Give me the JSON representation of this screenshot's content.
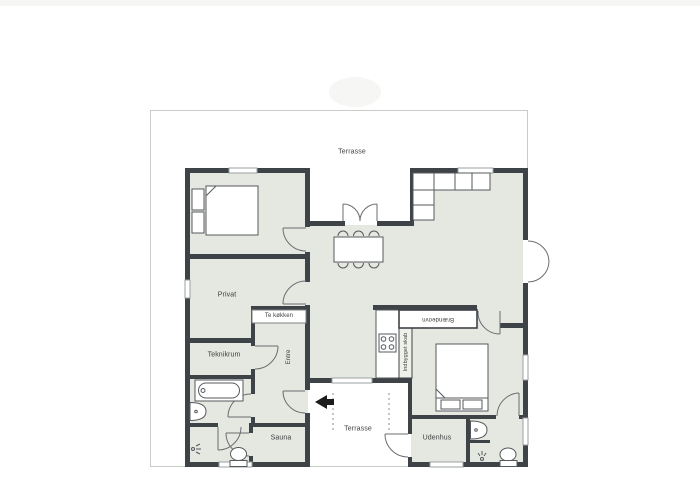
{
  "plan": {
    "colors": {
      "wall": "#3e4347",
      "room_fill": "#e5e7e1",
      "terrace_outline": "#c9cbc6",
      "furniture_stroke": "#55595c",
      "arrow": "#1c1c1c"
    },
    "rooms": {
      "terrace_top": "Terrasse",
      "privat": "Privat",
      "tea_kitchen": "Te køkken",
      "utility_room": "Teknikrum",
      "entrance_hall": "Entre",
      "sauna": "Sauna",
      "terrace_bottom": "Terrasse",
      "outhouse": "Udenhus",
      "wood_stove": "Brændeovn",
      "built_in_closet": "Indbygget skab"
    },
    "icons": {
      "entrance_arrow": "left-arrow",
      "fixtures": [
        "double-bed",
        "double-bed",
        "corner-sofa",
        "dining-table",
        "chairs",
        "stove-burners",
        "bathtub",
        "sink",
        "sink",
        "toilet",
        "toilet",
        "shower-head",
        "shower-head"
      ]
    }
  }
}
